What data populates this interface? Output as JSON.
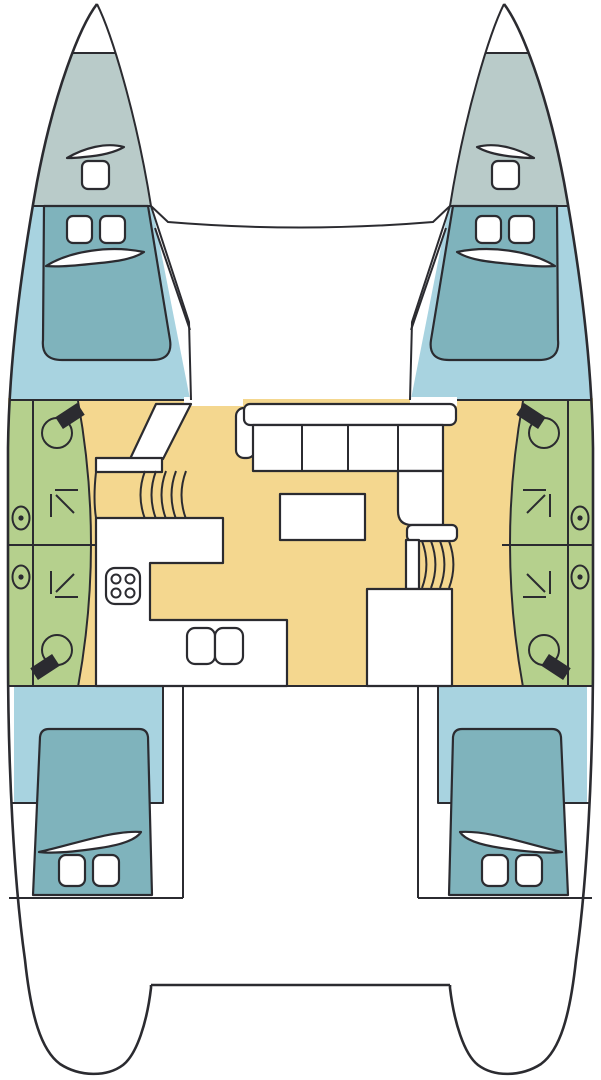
{
  "diagram": {
    "title": "Catamaran interior layout plan (bow up)",
    "type": "boat-deck-plan",
    "colors": {
      "outline": "#2b2b30",
      "deck_white": "#ffffff",
      "forepeak_gray": "#b9cbc9",
      "cabin_blue": "#a8d3e0",
      "bed_teal": "#7fb3bc",
      "heads_green": "#b5d08d",
      "floor_tan": "#f4d78f"
    },
    "legend": {
      "forepeak_gray": "forepeak lockers",
      "cabin_blue": "sleeping cabins",
      "bed_teal": "double berths",
      "heads_green": "bathrooms (WC and shower)",
      "floor_tan": "saloon, galley and corridor floor",
      "deck_white": "deck, furniture, cockpit and transoms"
    },
    "features": {
      "hulls": 2,
      "trampoline_foredeck": 1,
      "deck_hatches": 2,
      "cabins": [
        {
          "name": "port forward cabin",
          "berth": "double",
          "pillows": 2
        },
        {
          "name": "starboard forward cabin",
          "berth": "double",
          "pillows": 2
        },
        {
          "name": "port aft cabin",
          "berth": "double",
          "pillows": 2
        },
        {
          "name": "starboard aft cabin",
          "berth": "double",
          "pillows": 2
        }
      ],
      "heads": [
        {
          "name": "port forward head",
          "toilet": 1,
          "shower_arrow": "up-left",
          "porthole": 1
        },
        {
          "name": "port aft head",
          "toilet": 1,
          "shower_arrow": "down-left",
          "porthole": 1
        },
        {
          "name": "starboard forward head",
          "toilet": 1,
          "shower_arrow": "up-right",
          "porthole": 1
        },
        {
          "name": "starboard aft head",
          "toilet": 1,
          "shower_arrow": "down-right",
          "porthole": 1
        }
      ],
      "galley": {
        "stove_burners": 4,
        "sinks": 2,
        "counters": 1
      },
      "saloon": {
        "sofa": "L-shaped",
        "seat_cushions": 6,
        "table": 1
      },
      "companionways": [
        {
          "side": "port",
          "position": "forward",
          "steps": 5
        },
        {
          "side": "starboard",
          "position": "aft",
          "steps": 4
        }
      ],
      "cockpit": 1,
      "transom_platform": 1
    }
  }
}
